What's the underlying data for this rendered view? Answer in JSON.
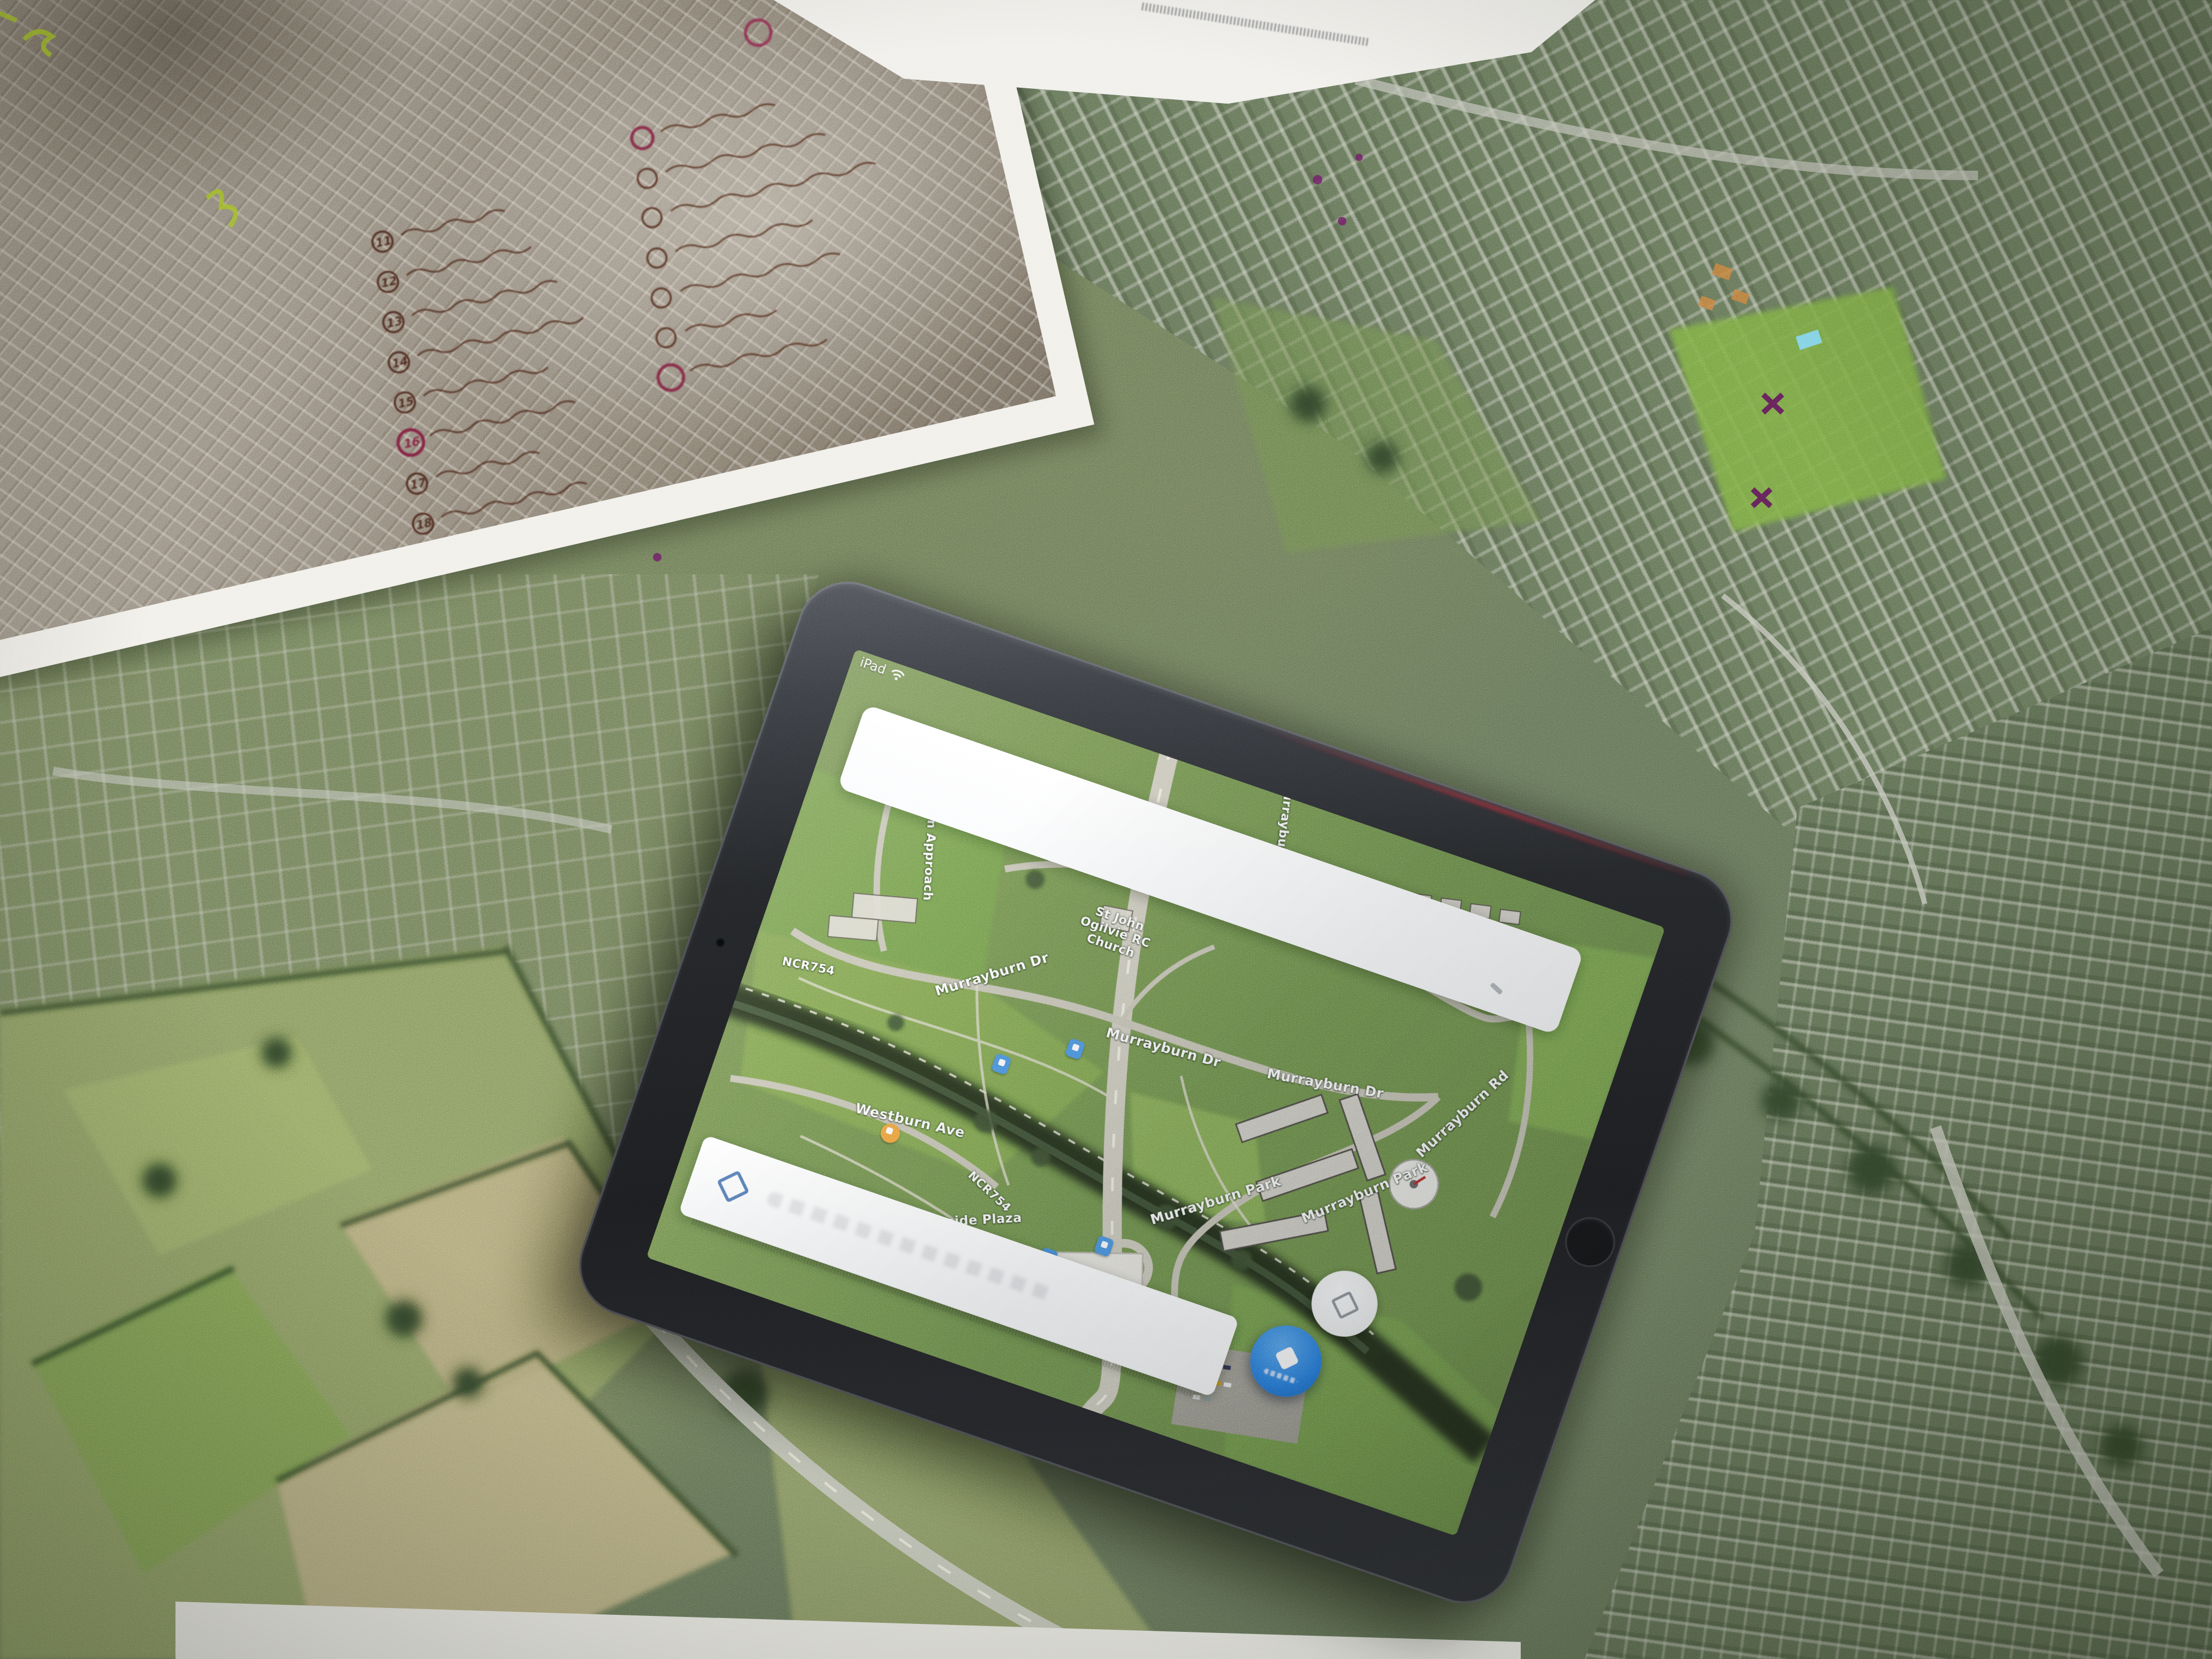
{
  "tablet": {
    "status_left": "iPad",
    "search_value": "",
    "map_labels": [
      "Sighthill Dr",
      "Sighthill Dr",
      "Murrayburn",
      "St John Ogilvie RC Church",
      "Murrayburn Approach",
      "Murrayburn Dr",
      "Murrayburn Dr",
      "Murrayburn Dr",
      "Murrayburn Rd",
      "Murrayburn Park",
      "Murrayburn Park",
      "NCR754",
      "NCR754",
      "Westburn Ave",
      "Westside Plaza",
      "Home Bargains"
    ],
    "colors": {
      "fab_blue": "#2a7cdf",
      "poi_blue": "#4a90e2",
      "poi_orange": "#f0a13c"
    }
  },
  "photo_print": {
    "list_numbers": [
      "11",
      "12",
      "13",
      "14",
      "15",
      "16",
      "17",
      "18"
    ]
  },
  "pens": {
    "red": "#b23530",
    "blue": "#4a97e0",
    "purple": "#8e3f9e",
    "pink": "#ef1a93"
  }
}
